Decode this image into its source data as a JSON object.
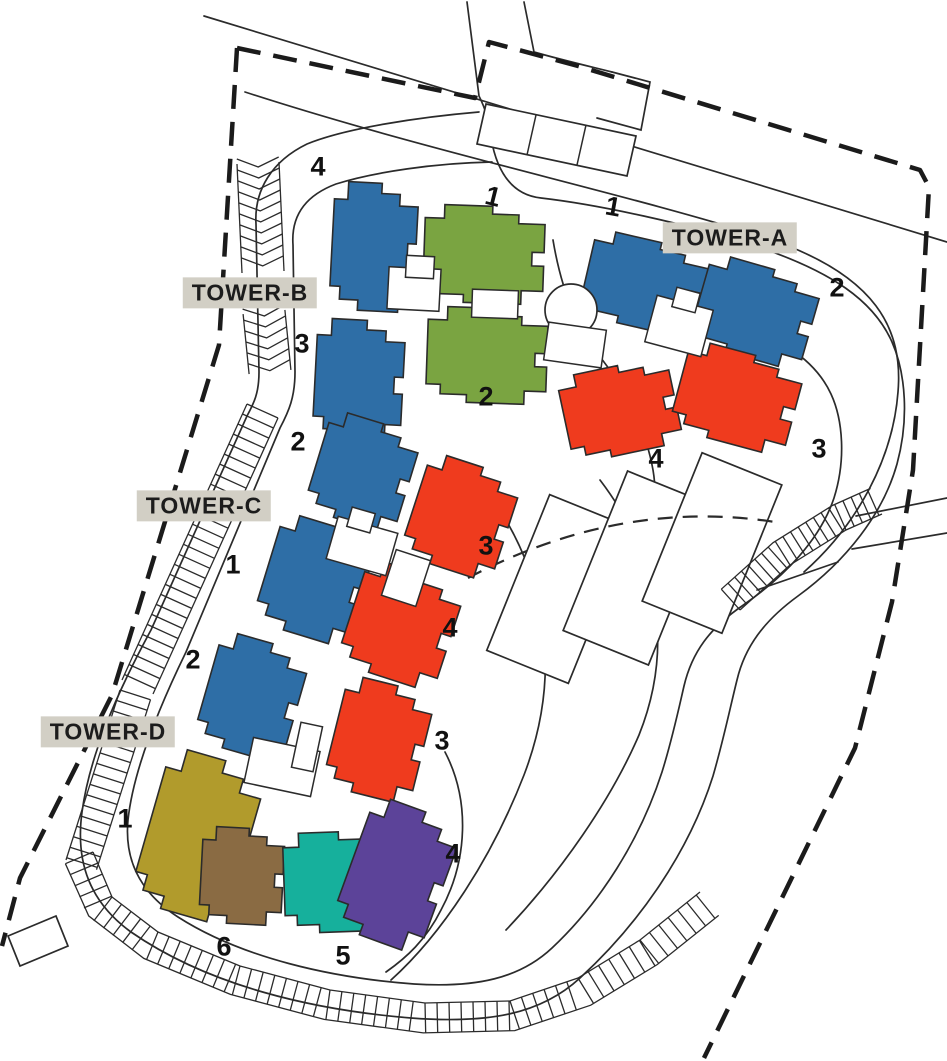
{
  "site_plan": {
    "towers": [
      {
        "label": "TOWER-A"
      },
      {
        "label": "TOWER-B"
      },
      {
        "label": "TOWER-C"
      },
      {
        "label": "TOWER-D"
      }
    ],
    "unit_numbers": [
      "4",
      "1",
      "1",
      "2",
      "3",
      "2",
      "4",
      "3",
      "2",
      "1",
      "3",
      "4",
      "2",
      "3",
      "1",
      "4",
      "6",
      "5"
    ],
    "colors": {
      "tower_block_blue": "#2E6EA6",
      "block_green": "#7AA441",
      "block_red": "#EF3B1E",
      "block_olive": "#B19B2C",
      "block_brown": "#8A6B43",
      "block_teal": "#16B09C",
      "block_purple": "#5C4399",
      "label_background": "#D2CFC5",
      "line": "#2B2B2B",
      "core_white": "#FFFFFF"
    }
  }
}
